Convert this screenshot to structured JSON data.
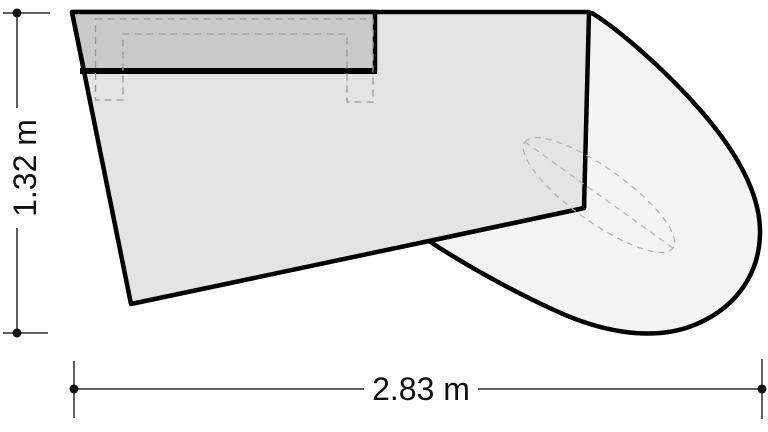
{
  "figure": {
    "kind": "furniture-plan-technical-drawing",
    "background": "#ffffff",
    "labels": {
      "height": "1.32 m",
      "width": "2.83 m"
    },
    "values": {
      "height_m": 1.32,
      "width_m": 2.83
    },
    "colors": {
      "outline": "#000000",
      "body_fill": "#e4e4e4",
      "top_panel_fill": "#c9c9c9",
      "wing_fill": "#f4f4f4",
      "dimension_line": "#2b2b2b",
      "dot_fill": "#111111",
      "hidden_line": "#9a9a9a",
      "ellipse_line": "#b3b3b3"
    },
    "geometry": {
      "wing": "M 592,13 C 625,34 670,75 702,112 C 733,148 761,192 760,234 C 759,276 734,311 689,327 C 648,341 599,331 554,310 C 508,289 459,261 429,241 L 584,208 L 586,16 Z",
      "body": "M 72,12 L 589,12 L 584,208 L 429,241 L 131,304 Z",
      "top_panel": "M 72,12 L 375,12 L 375,71 L 84,71 Z",
      "top_panel_bar": "M 80,71 L 377,71",
      "hidden_frame": "M 95.5,19 L 373,19 L 373,102 L 347,102 L 347,34 L 123,34 L 123,100 L 95.5,100 Z",
      "ellipse": "M 525,142 A 91,27 35.6 0 1 673,248 A 91,27 35.6 0 1 525,142 Z",
      "ellipse_axis": "M 525,142 L 673,248",
      "dim_v_line_upper": "M 17,13 L 17,108",
      "dim_v_line_lower": "M 17,228 L 17,333",
      "dim_v_tick_top": "M 3,13 L 50,13",
      "dim_v_tick_bottom": "M 3,333 L 48,333",
      "dim_h_line_left": "M 74,389 L 364,389",
      "dim_h_line_right": "M 478,389 L 762,389",
      "dim_h_tick_left": "M 74,361 L 74,418",
      "dim_h_tick_right": "M 762,359 L 762,419",
      "dots": [
        {
          "cx": 17,
          "cy": 13,
          "r": 4.5
        },
        {
          "cx": 17,
          "cy": 333,
          "r": 4.5
        },
        {
          "cx": 74,
          "cy": 389,
          "r": 4.5
        },
        {
          "cx": 762,
          "cy": 389,
          "r": 4.5
        }
      ],
      "v_label": {
        "x": 25,
        "y": 168,
        "transform": "rotate(-90 25 168)"
      },
      "h_label": {
        "x": 421,
        "y": 389
      }
    }
  }
}
